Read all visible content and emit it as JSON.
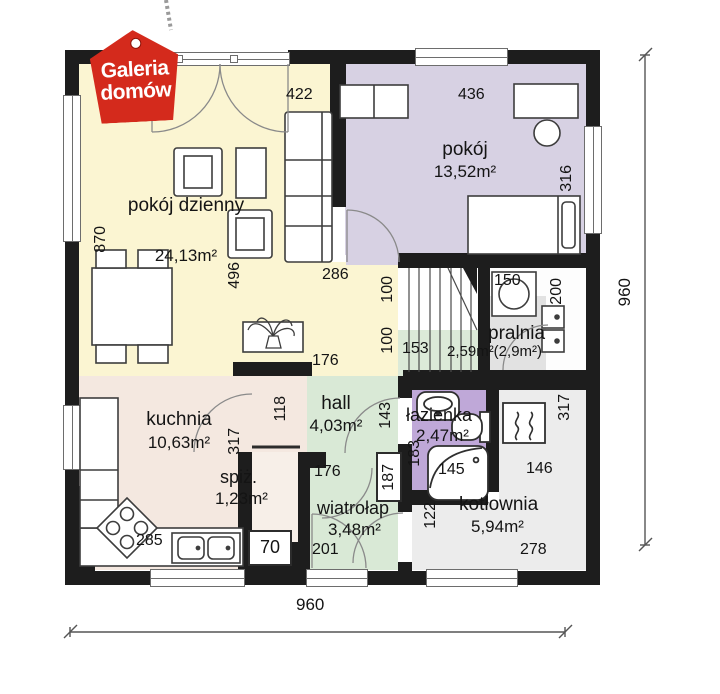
{
  "logo": {
    "line1": "Galeria",
    "line2": "domów"
  },
  "rooms": {
    "living": {
      "name": "pokój dzienny",
      "area": "24,13m²"
    },
    "bedroom": {
      "name": "pokój",
      "area": "13,52m²"
    },
    "laundry": {
      "name": "pralnia",
      "area": "2,59m²(2,9m²)"
    },
    "hall": {
      "name": "hall",
      "area": "4,03m²"
    },
    "bathroom": {
      "name": "łazienka",
      "area": "2,47m²"
    },
    "kitchen": {
      "name": "kuchnia",
      "area": "10,63m²"
    },
    "pantry": {
      "name": "spiż.",
      "area": "1,23m²"
    },
    "vestibule": {
      "name": "wiatrołap",
      "area": "3,48m²"
    },
    "boiler": {
      "name": "kotłownia",
      "area": "5,94m²"
    }
  },
  "dims": {
    "overall_width": "960",
    "overall_height": "960",
    "d422": "422",
    "d436": "436",
    "d316": "316",
    "d870": "870",
    "d496": "496",
    "d286": "286",
    "d100a": "100",
    "d100b": "100",
    "d150": "150",
    "d200": "200",
    "d153": "153",
    "d176_hall": "176",
    "d118": "118",
    "d143": "143",
    "d183": "183",
    "d145": "145",
    "d317_kitchen": "317",
    "d176_vestibule": "176",
    "d187": "187",
    "d122": "122",
    "d146": "146",
    "d317_boiler": "317",
    "d70": "70",
    "d201": "201",
    "d285": "285",
    "d278": "278"
  },
  "colors": {
    "wall": "#1d1d1d",
    "living": "#fbf5d2",
    "bedroom": "#d7d1e3",
    "green": "#d9e9d6",
    "kitchen": "#f4e8e0",
    "bathroom": "#bfa8d8",
    "boiler": "#ececec",
    "laundry_patch": "#e2e2e2",
    "logo_red": "#d42a1c"
  }
}
